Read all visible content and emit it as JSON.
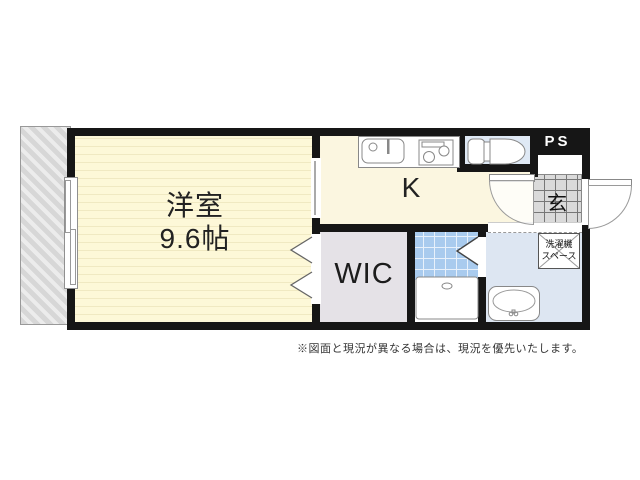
{
  "rooms": {
    "main_room": {
      "name": "洋室",
      "size": "9.6帖"
    },
    "kitchen": {
      "label": "K"
    },
    "wic": {
      "label": "WIC"
    },
    "entrance": {
      "label": "玄"
    },
    "pipe_space": {
      "label": "PS"
    },
    "washer_space": {
      "line1": "洗濯機",
      "line2": "スペース"
    }
  },
  "note": "※図面と現況が異なる場合は、現況を優先いたします。",
  "colors": {
    "wall": "#161616",
    "main_room_floor": "#fdf8d8",
    "kitchen_floor": "#fbf6e0",
    "toilet_floor": "#dfe9f5",
    "bathroom_floor": "#dde6f2",
    "washroom_tile": "#a9cbee",
    "wic_floor": "#e5e2e7",
    "entrance_tile": "#dadada",
    "balcony": "#d7d7d7"
  }
}
